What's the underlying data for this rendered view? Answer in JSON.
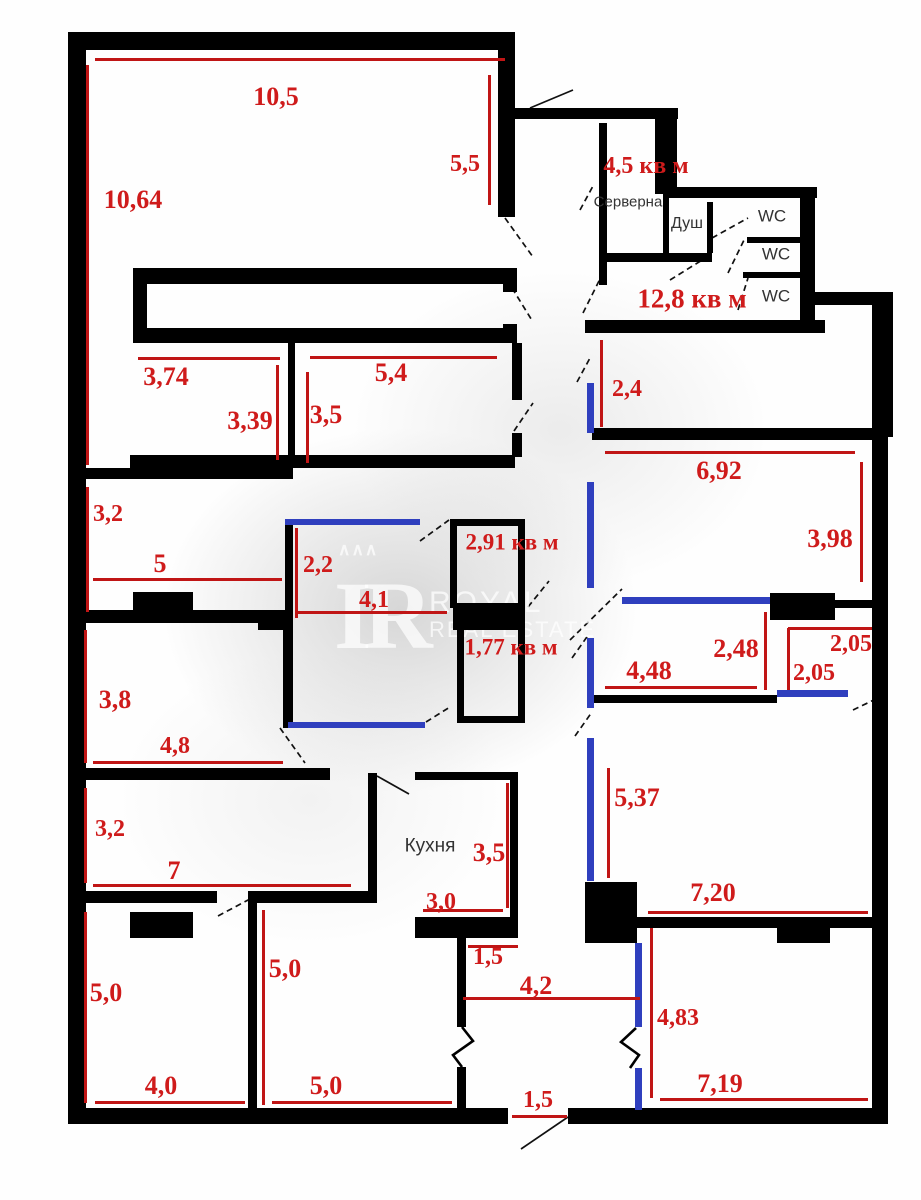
{
  "watermark": {
    "logo_crown": "∧∧∧",
    "logo_text": "IR",
    "brand_line1": "ROYAL",
    "brand_line2": "REAL ESTATE"
  },
  "colors": {
    "wall": "#000000",
    "partition_blue": "#2f3fbe",
    "dimension_line": "#c01515",
    "dimension_text": "#cf1b1b",
    "room_text": "#333333",
    "watermark": "#e9e9e9"
  },
  "room_labels": [
    {
      "t": "Серверна",
      "x": 628,
      "y": 202,
      "s": 15
    },
    {
      "t": "Душ",
      "x": 687,
      "y": 224,
      "s": 16
    },
    {
      "t": "WC",
      "x": 772,
      "y": 216,
      "s": 17
    },
    {
      "t": "WC",
      "x": 776,
      "y": 254,
      "s": 17
    },
    {
      "t": "WC",
      "x": 776,
      "y": 296,
      "s": 17
    },
    {
      "t": "Кухня",
      "x": 430,
      "y": 846,
      "s": 19
    }
  ],
  "area_labels": [
    {
      "t": "4,5 кв м",
      "x": 646,
      "y": 166,
      "s": 24,
      "b": true
    },
    {
      "t": "12,8 кв м",
      "x": 692,
      "y": 299,
      "s": 27,
      "b": true
    },
    {
      "t": "2,91 кв м",
      "x": 512,
      "y": 542,
      "s": 23,
      "b": true
    },
    {
      "t": "1,77 кв м",
      "x": 511,
      "y": 647,
      "s": 23,
      "b": true
    }
  ],
  "dimension_labels": [
    {
      "t": "10,5",
      "x": 276,
      "y": 97,
      "s": 26
    },
    {
      "t": "10,64",
      "x": 133,
      "y": 200,
      "s": 26
    },
    {
      "t": "5,5",
      "x": 465,
      "y": 164,
      "s": 24
    },
    {
      "t": "2,4",
      "x": 627,
      "y": 389,
      "s": 24
    },
    {
      "t": "6,92",
      "x": 719,
      "y": 471,
      "s": 26
    },
    {
      "t": "3,98",
      "x": 830,
      "y": 539,
      "s": 26
    },
    {
      "t": "3,74",
      "x": 166,
      "y": 377,
      "s": 26
    },
    {
      "t": "3,39",
      "x": 250,
      "y": 421,
      "s": 26
    },
    {
      "t": "5,4",
      "x": 391,
      "y": 373,
      "s": 26
    },
    {
      "t": "3,5",
      "x": 326,
      "y": 415,
      "s": 26
    },
    {
      "t": "3,2",
      "x": 108,
      "y": 514,
      "s": 24
    },
    {
      "t": "5",
      "x": 160,
      "y": 564,
      "s": 26
    },
    {
      "t": "2,2",
      "x": 318,
      "y": 565,
      "s": 24
    },
    {
      "t": "4,1",
      "x": 374,
      "y": 600,
      "s": 24
    },
    {
      "t": "2,48",
      "x": 736,
      "y": 649,
      "s": 26
    },
    {
      "t": "4,48",
      "x": 649,
      "y": 671,
      "s": 26
    },
    {
      "t": "2,05",
      "x": 851,
      "y": 644,
      "s": 24
    },
    {
      "t": "2,05",
      "x": 814,
      "y": 673,
      "s": 24
    },
    {
      "t": "3,8",
      "x": 115,
      "y": 700,
      "s": 26
    },
    {
      "t": "4,8",
      "x": 175,
      "y": 746,
      "s": 24
    },
    {
      "t": "3,2",
      "x": 110,
      "y": 829,
      "s": 24
    },
    {
      "t": "7",
      "x": 174,
      "y": 871,
      "s": 26
    },
    {
      "t": "5,37",
      "x": 637,
      "y": 798,
      "s": 26
    },
    {
      "t": "7,20",
      "x": 713,
      "y": 893,
      "s": 26
    },
    {
      "t": "3,5",
      "x": 489,
      "y": 853,
      "s": 26
    },
    {
      "t": "3,0",
      "x": 441,
      "y": 902,
      "s": 24
    },
    {
      "t": "1,5",
      "x": 488,
      "y": 957,
      "s": 24
    },
    {
      "t": "4,2",
      "x": 536,
      "y": 986,
      "s": 26
    },
    {
      "t": "5,0",
      "x": 106,
      "y": 993,
      "s": 26
    },
    {
      "t": "4,0",
      "x": 161,
      "y": 1086,
      "s": 26
    },
    {
      "t": "5,0",
      "x": 285,
      "y": 969,
      "s": 26
    },
    {
      "t": "5,0",
      "x": 326,
      "y": 1086,
      "s": 26
    },
    {
      "t": "4,83",
      "x": 678,
      "y": 1018,
      "s": 24
    },
    {
      "t": "7,19",
      "x": 720,
      "y": 1084,
      "s": 26
    },
    {
      "t": "1,5",
      "x": 538,
      "y": 1100,
      "s": 24
    }
  ],
  "plan": {
    "walls": [
      [
        68,
        32,
        445,
        18
      ],
      [
        68,
        32,
        18,
        1091
      ],
      [
        68,
        1108,
        440,
        16
      ],
      [
        568,
        1108,
        320,
        16
      ],
      [
        872,
        292,
        16,
        832
      ],
      [
        815,
        292,
        78,
        13
      ],
      [
        873,
        305,
        20,
        132
      ],
      [
        498,
        32,
        17,
        185
      ],
      [
        508,
        108,
        170,
        11
      ],
      [
        655,
        108,
        22,
        86
      ],
      [
        663,
        187,
        154,
        11
      ],
      [
        800,
        187,
        15,
        146
      ],
      [
        585,
        320,
        240,
        13
      ],
      [
        592,
        428,
        288,
        12
      ],
      [
        599,
        123,
        8,
        162
      ],
      [
        599,
        253,
        113,
        9
      ],
      [
        663,
        198,
        6,
        55
      ],
      [
        707,
        202,
        6,
        51
      ],
      [
        747,
        237,
        53,
        6
      ],
      [
        743,
        272,
        57,
        6
      ],
      [
        133,
        268,
        384,
        16
      ],
      [
        133,
        328,
        384,
        15
      ],
      [
        133,
        268,
        14,
        75
      ],
      [
        503,
        268,
        14,
        24
      ],
      [
        503,
        324,
        14,
        19
      ],
      [
        288,
        343,
        7,
        112
      ],
      [
        512,
        343,
        10,
        57
      ],
      [
        512,
        433,
        10,
        24
      ],
      [
        130,
        455,
        385,
        13
      ],
      [
        68,
        468,
        225,
        11
      ],
      [
        285,
        520,
        8,
        100
      ],
      [
        258,
        615,
        35,
        15
      ],
      [
        283,
        617,
        10,
        111
      ],
      [
        68,
        610,
        225,
        13
      ],
      [
        68,
        768,
        262,
        12
      ],
      [
        68,
        891,
        149,
        12
      ],
      [
        248,
        891,
        129,
        12
      ],
      [
        248,
        900,
        9,
        208
      ],
      [
        368,
        773,
        9,
        127
      ],
      [
        415,
        772,
        103,
        8
      ],
      [
        510,
        780,
        8,
        137
      ],
      [
        415,
        917,
        103,
        21
      ],
      [
        457,
        938,
        9,
        89
      ],
      [
        457,
        1067,
        9,
        43
      ],
      [
        637,
        917,
        238,
        11
      ],
      [
        592,
        695,
        185,
        8
      ],
      [
        835,
        600,
        42,
        8
      ],
      [
        450,
        519,
        75,
        7
      ],
      [
        450,
        519,
        7,
        89
      ],
      [
        518,
        519,
        7,
        89
      ],
      [
        453,
        603,
        72,
        27
      ],
      [
        457,
        628,
        7,
        95
      ],
      [
        518,
        628,
        7,
        95
      ],
      [
        457,
        716,
        68,
        7
      ]
    ],
    "blocks": [
      [
        133,
        592,
        60,
        23
      ],
      [
        130,
        912,
        63,
        26
      ],
      [
        585,
        882,
        52,
        61
      ],
      [
        777,
        922,
        53,
        21
      ],
      [
        770,
        593,
        65,
        27
      ]
    ],
    "partitions": [
      [
        285,
        519,
        135,
        6
      ],
      [
        288,
        722,
        137,
        6
      ],
      [
        587,
        383,
        7,
        50
      ],
      [
        587,
        482,
        7,
        106
      ],
      [
        587,
        638,
        7,
        70
      ],
      [
        587,
        738,
        7,
        143
      ],
      [
        622,
        597,
        148,
        7
      ],
      [
        777,
        690,
        71,
        7
      ],
      [
        635,
        943,
        7,
        84
      ],
      [
        635,
        1068,
        7,
        42
      ]
    ],
    "red_lines": [
      [
        95,
        58,
        410,
        3
      ],
      [
        86,
        65,
        3,
        400
      ],
      [
        488,
        75,
        3,
        130
      ],
      [
        600,
        340,
        3,
        87
      ],
      [
        605,
        451,
        250,
        3
      ],
      [
        860,
        462,
        3,
        120
      ],
      [
        138,
        357,
        142,
        3
      ],
      [
        276,
        365,
        3,
        95
      ],
      [
        310,
        356,
        187,
        3
      ],
      [
        306,
        372,
        3,
        91
      ],
      [
        86,
        487,
        3,
        125
      ],
      [
        93,
        578,
        189,
        3
      ],
      [
        295,
        528,
        3,
        90
      ],
      [
        298,
        611,
        149,
        3
      ],
      [
        764,
        612,
        3,
        78
      ],
      [
        605,
        686,
        152,
        3
      ],
      [
        788,
        627,
        84,
        3
      ],
      [
        787,
        628,
        3,
        62
      ],
      [
        84,
        630,
        3,
        133
      ],
      [
        93,
        761,
        190,
        3
      ],
      [
        84,
        788,
        3,
        95
      ],
      [
        93,
        884,
        258,
        3
      ],
      [
        607,
        768,
        3,
        110
      ],
      [
        648,
        911,
        220,
        3
      ],
      [
        506,
        783,
        3,
        125
      ],
      [
        423,
        909,
        80,
        3
      ],
      [
        468,
        945,
        50,
        3
      ],
      [
        463,
        997,
        177,
        3
      ],
      [
        262,
        910,
        3,
        195
      ],
      [
        84,
        912,
        3,
        191
      ],
      [
        95,
        1101,
        150,
        3
      ],
      [
        272,
        1101,
        180,
        3
      ],
      [
        650,
        928,
        3,
        170
      ],
      [
        660,
        1098,
        208,
        3
      ],
      [
        512,
        1115,
        55,
        3
      ]
    ],
    "door_lines": [
      [
        530,
        108,
        573,
        90,
        false
      ],
      [
        505,
        218,
        533,
        257,
        true
      ],
      [
        512,
        288,
        533,
        322,
        true
      ],
      [
        514,
        431,
        533,
        403,
        true
      ],
      [
        580,
        210,
        593,
        186,
        true
      ],
      [
        583,
        313,
        603,
        273,
        true
      ],
      [
        670,
        280,
        707,
        257,
        true
      ],
      [
        712,
        238,
        748,
        218,
        true
      ],
      [
        728,
        273,
        745,
        238,
        true
      ],
      [
        738,
        310,
        748,
        278,
        true
      ],
      [
        577,
        382,
        590,
        358,
        true
      ],
      [
        570,
        640,
        622,
        589,
        true
      ],
      [
        853,
        710,
        880,
        697,
        true
      ],
      [
        280,
        728,
        305,
        763,
        true
      ],
      [
        218,
        916,
        250,
        899,
        true
      ],
      [
        377,
        776,
        409,
        794,
        false
      ],
      [
        568,
        1117,
        521,
        1149,
        false
      ],
      [
        420,
        541,
        449,
        520,
        true
      ],
      [
        426,
        722,
        450,
        707,
        true
      ],
      [
        528,
        607,
        549,
        581,
        true
      ],
      [
        572,
        658,
        589,
        634,
        true
      ],
      [
        575,
        736,
        592,
        712,
        true
      ]
    ],
    "zigzags": [
      "462,1027 473,1041 453,1055 462,1067",
      "636,1028 621,1042 639,1055 630,1068"
    ]
  }
}
